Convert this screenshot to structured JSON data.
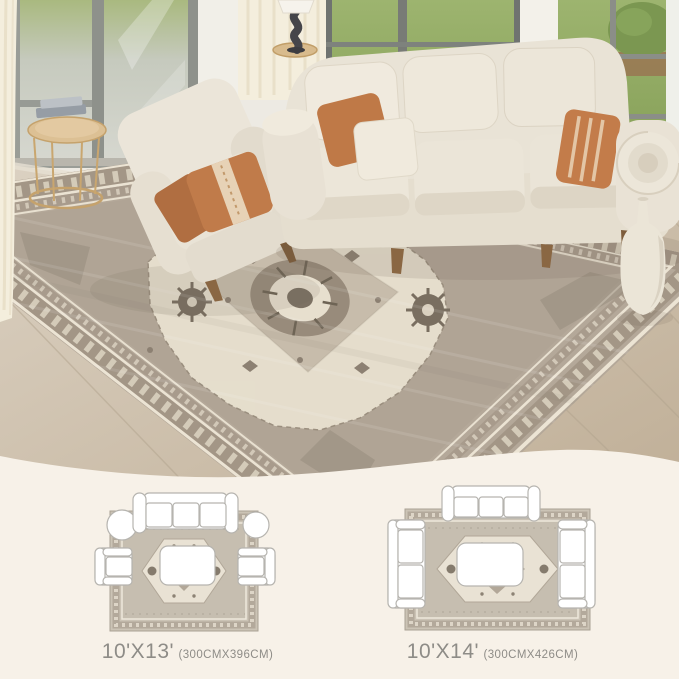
{
  "size_options": [
    {
      "id": "10x13",
      "feet": "10'X13'",
      "cm": "(300CMX396CM)"
    },
    {
      "id": "10x14",
      "feet": "10'X14'",
      "cm": "(300CMX426CM)"
    }
  ],
  "colors": {
    "panel_background": "#f7f1e8",
    "label_text": "#8e8c87",
    "rug_field": "#b2a697",
    "rug_border_band": "#a39686",
    "rug_cream": "#e8e0cf",
    "pillow_accent": "#c17c4b",
    "sofa_fabric": "#eae4d7",
    "floor_wood": "#cdc0ae",
    "grass": "#8ea463",
    "table_gold": "#c5a26c"
  }
}
